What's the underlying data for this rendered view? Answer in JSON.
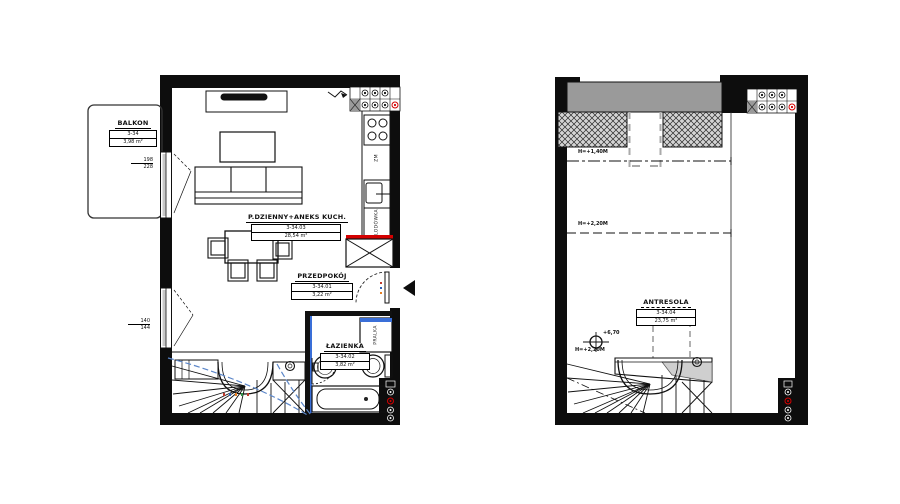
{
  "plans": {
    "level": {
      "rooms": {
        "balkon": {
          "name": "BALKON",
          "number": "3-34",
          "area": "3,98 m²"
        },
        "living": {
          "name": "P.DZIENNY+ANEKS KUCH.",
          "number": "3-34.03",
          "area": "28,54 m²"
        },
        "przedpokoj": {
          "name": "PRZEDPOKÓJ",
          "number": "3-34.01",
          "area": "3,22 m²"
        },
        "lazienka": {
          "name": "ŁAZIENKA",
          "number": "3-34.02",
          "area": "3,82 m²"
        }
      },
      "appliances": {
        "fridge": "LODÓWKA",
        "washer": "PRALKA",
        "dishwasher": "ZM"
      },
      "window_dims": {
        "balcony_top": "198",
        "balcony_bottom": "228",
        "side_top": "140",
        "side_bottom": "144"
      }
    },
    "mezzanine": {
      "rooms": {
        "antresola": {
          "name": "ANTRESOLA",
          "number": "3-34.04",
          "area": "23,75 m²"
        }
      },
      "height_lines": {
        "h140": "H=+1,40M",
        "h220": "H=+2,20M",
        "h220_stair": "H=+2,20M"
      },
      "level_mark": "+6,70"
    },
    "colors": {
      "wall": "#0d0d0d",
      "accent_red": "#d40000",
      "accent_blue": "#3a6fd8",
      "headroom_blue": "#5b86c9",
      "roof_gray": "#9a9a9a"
    }
  }
}
